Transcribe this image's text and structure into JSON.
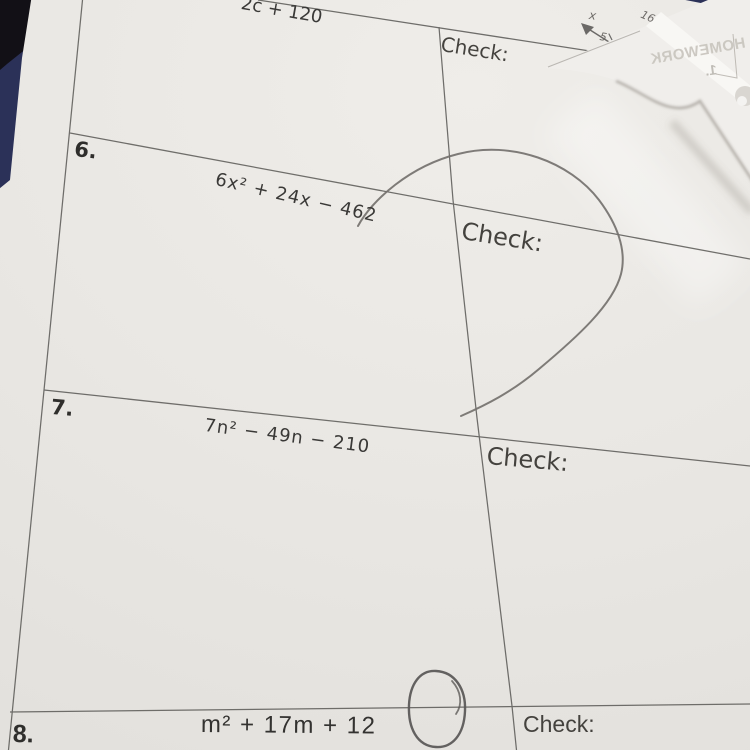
{
  "scene": {
    "type": "photo of a factoring worksheet lying on a dark table",
    "colors": {
      "table_dark": "#121016",
      "table_navy": "#2b3158",
      "paper": "#e9e7e3",
      "overlay_paper": "#f1efec",
      "fold_highlight": "#f8f7f4",
      "printed_line": "#5d5c59",
      "printed_text": "#3a3937",
      "pencil": "#73706d",
      "mirrored_text": "#c8c4bd"
    }
  },
  "worksheet": {
    "row5": {
      "expression_fragment": "2c + 120",
      "check_label": "Check:"
    },
    "row6": {
      "number": "6.",
      "expression": "6x² + 24x − 462",
      "check_label": "Check:"
    },
    "row7": {
      "number": "7.",
      "expression": "7n² − 49n − 210",
      "check_label": "Check:"
    },
    "row8": {
      "number": "8.",
      "expression": "m² + 17m + 12",
      "check_label": "Check:"
    }
  },
  "pencil_annotations": {
    "angle_sketch_labels": {
      "x": "x",
      "five": "5",
      "sixteen": "16"
    }
  },
  "overlay_paper": {
    "mirrored_title": "HOMEWORK",
    "mirrored_number": "1."
  }
}
